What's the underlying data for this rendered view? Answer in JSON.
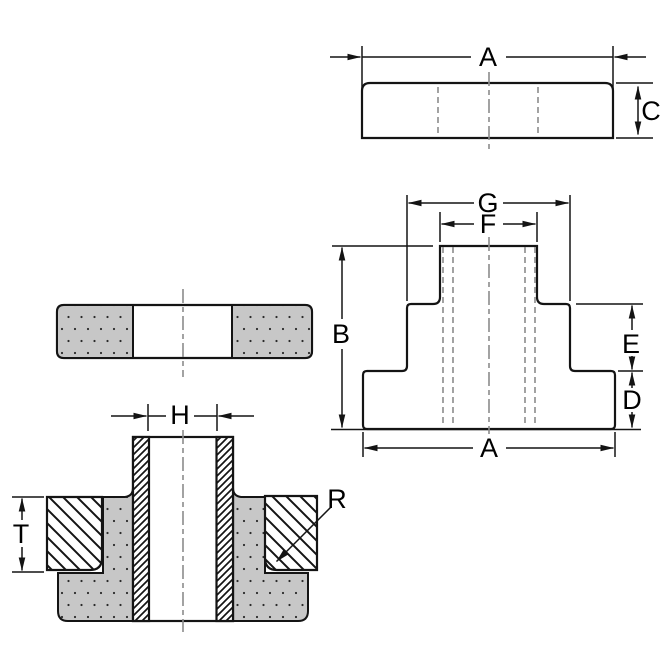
{
  "title": "Grommet / bushing multi-view dimension drawing",
  "labels": {
    "a_top": "A",
    "c": "C",
    "g": "G",
    "f": "F",
    "b": "B",
    "e": "E",
    "d": "D",
    "a_bottom": "A",
    "h": "H",
    "t": "T",
    "r": "R"
  },
  "colors": {
    "line": "#141414",
    "hidden_line": "#8c8c8c",
    "rubber_fill": "#c7c7c7",
    "background": "#ffffff",
    "label_text": "#000000"
  }
}
